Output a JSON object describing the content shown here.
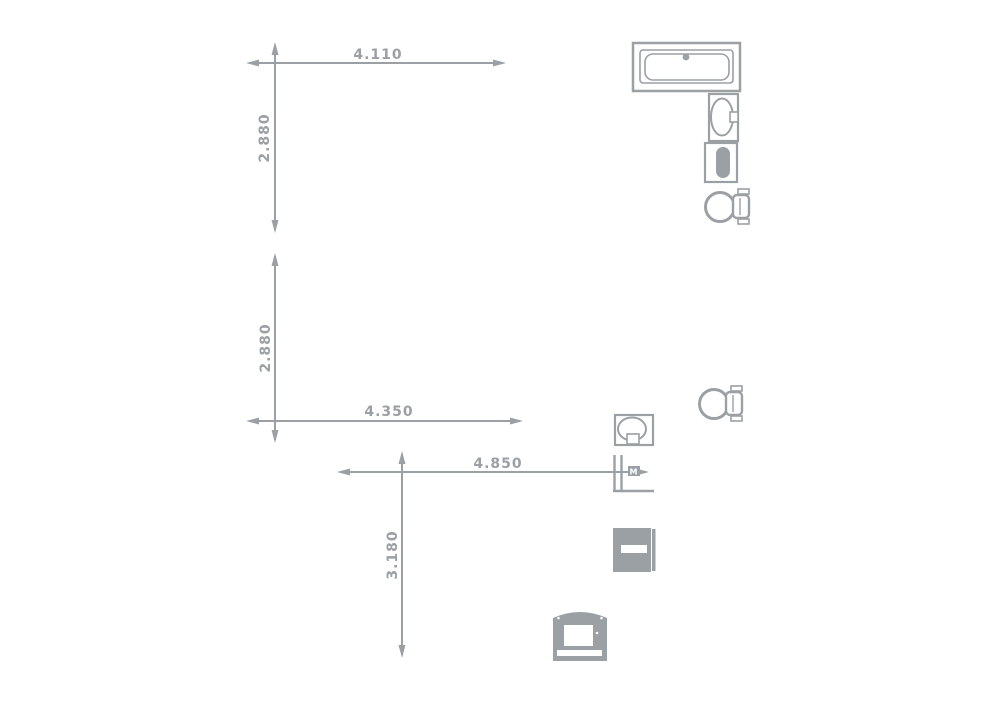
{
  "drawing": {
    "kind": "floor-plan-fragment",
    "background_color": "#ffffff",
    "line_color": "#9ba0a5"
  },
  "dimensions": {
    "top_width": {
      "label": "4.110",
      "orientation": "horizontal"
    },
    "upper_left_height": {
      "label": "2.880",
      "orientation": "vertical"
    },
    "lower_left_height": {
      "label": "2.880",
      "orientation": "vertical"
    },
    "middle_width": {
      "label": "4.350",
      "orientation": "horizontal"
    },
    "lower_width": {
      "label": "4.850",
      "orientation": "horizontal"
    },
    "bottom_height": {
      "label": "3.180",
      "orientation": "vertical"
    }
  },
  "annotations": {
    "door_box_label": "M"
  },
  "fixtures": [
    {
      "name": "bathtub-icon"
    },
    {
      "name": "washbasin-icon"
    },
    {
      "name": "boiler-icon"
    },
    {
      "name": "toilet-upper-icon"
    },
    {
      "name": "toilet-middle-icon"
    },
    {
      "name": "sink-top-view-icon"
    },
    {
      "name": "door-opening-icon"
    },
    {
      "name": "washing-machine-icon"
    },
    {
      "name": "oven-front-icon"
    }
  ]
}
